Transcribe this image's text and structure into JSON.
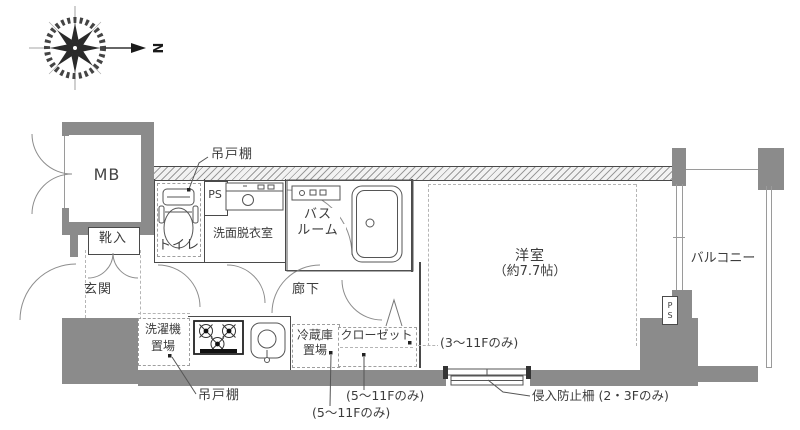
{
  "compass": {
    "north_label": "N"
  },
  "rooms": {
    "mb": "MB",
    "shoe_cabinet": "靴入",
    "entrance": "玄関",
    "toilet": "トイレ",
    "pipe_space_top": "PS",
    "washroom": "洗面脱衣室",
    "bathroom": {
      "line1": "バス",
      "line2": "ルーム"
    },
    "hallway": "廊下",
    "laundry": {
      "line1": "洗濯機",
      "line2": "置場"
    },
    "fridge": {
      "line1": "冷蔵庫",
      "line2": "置場"
    },
    "closet": "クローゼット",
    "western_room": {
      "line1": "洋室",
      "line2": "（約7.7帖）"
    },
    "balcony": "バルコニー",
    "pipe_space_right": {
      "line1": "P",
      "line2": "S"
    }
  },
  "annotations": {
    "hanging_cupboard_top": "吊戸棚",
    "hanging_cupboard_bottom": "吊戸棚",
    "closet_floors": "(5〜11Fのみ)",
    "fridge_floors": "(5〜11Fのみ)",
    "room_floors": "(3〜11Fのみ)",
    "intrusion_fence": "侵入防止柵 (2・3Fのみ)"
  },
  "colors": {
    "wall": "#8b8b8b",
    "line": "#4a4a4a",
    "text": "#3c3c3c",
    "dash": "#b5b5b5"
  }
}
